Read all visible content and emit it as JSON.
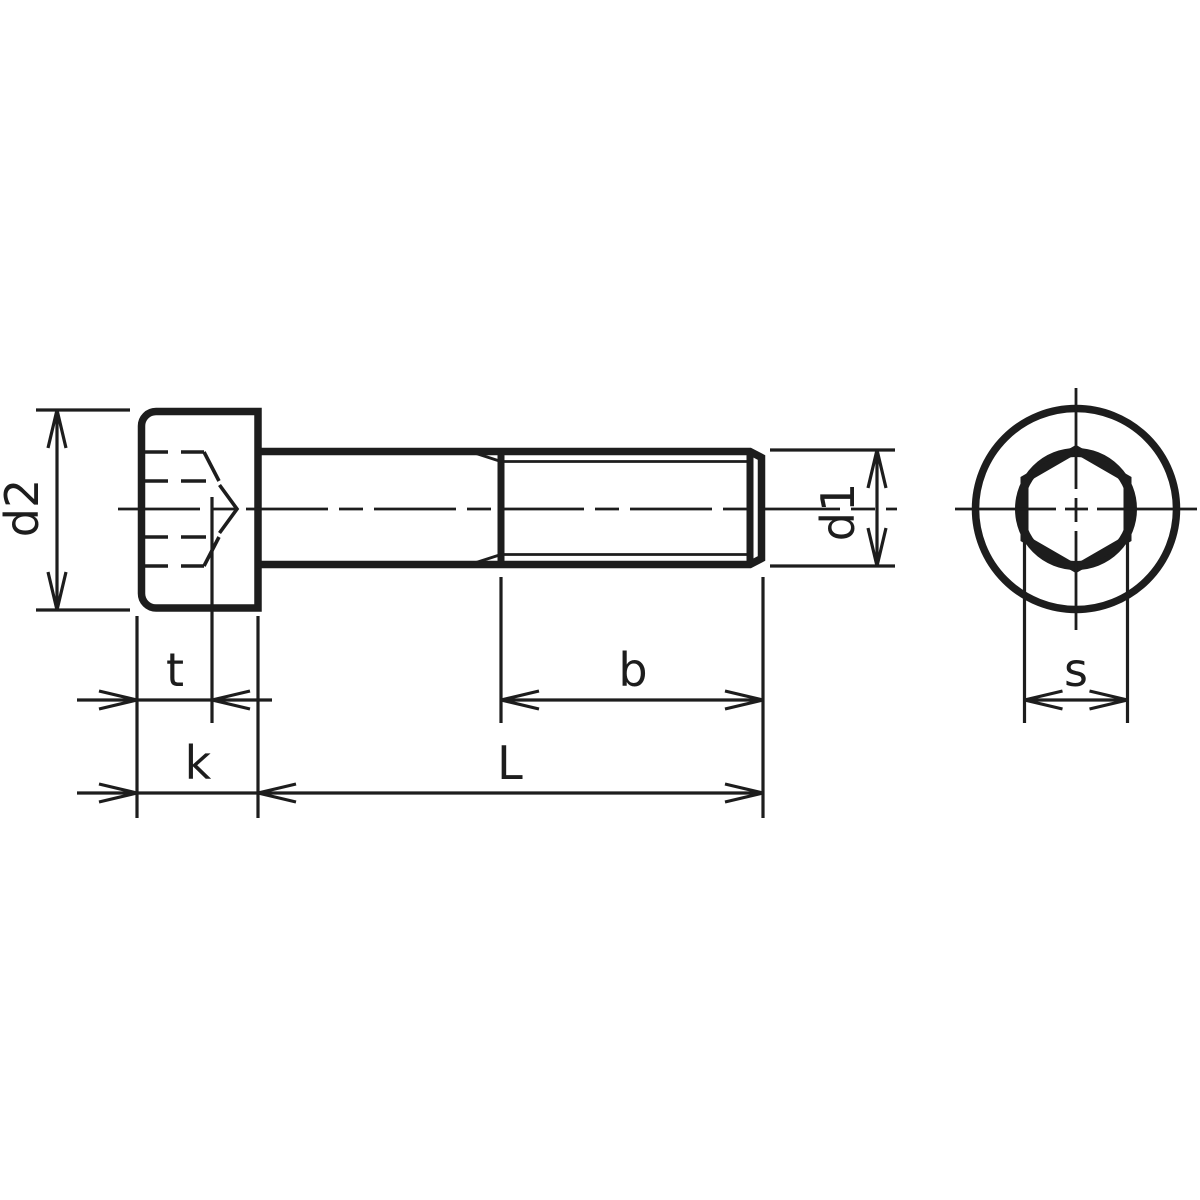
{
  "canvas": {
    "background": "#ffffff",
    "line_color": "#1d1d1d"
  },
  "front_view": {
    "description": "socket head cap screw side view",
    "labels": {
      "head_diameter": "d2",
      "socket_depth": "t",
      "head_height": "k",
      "thread_length": "b",
      "total_length": "L",
      "shank_diameter": "d1"
    }
  },
  "end_view": {
    "description": "screw head end view with hex socket",
    "labels": {
      "socket_width_across_flats": "s"
    }
  }
}
